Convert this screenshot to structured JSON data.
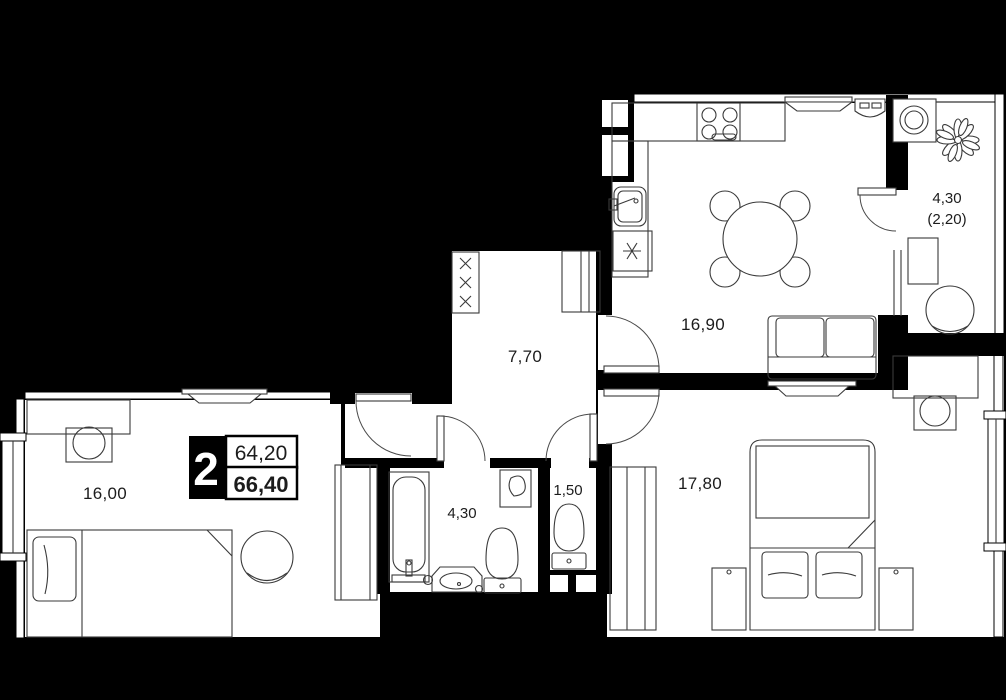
{
  "plan": {
    "badge": {
      "room_count": "2",
      "area_top": "64,20",
      "area_bottom": "66,40"
    },
    "rooms": {
      "living": {
        "area": "16,90"
      },
      "balcony": {
        "area": "4,30",
        "area_secondary": "(2,20)"
      },
      "hallway": {
        "area": "7,70"
      },
      "room_left": {
        "area": "16,00"
      },
      "bathroom": {
        "area": "4,30"
      },
      "wc": {
        "area": "1,50"
      },
      "bedroom": {
        "area": "17,80"
      }
    },
    "colors": {
      "background": "#000000",
      "floor": "#ffffff",
      "line": "#3a3a3a"
    }
  }
}
